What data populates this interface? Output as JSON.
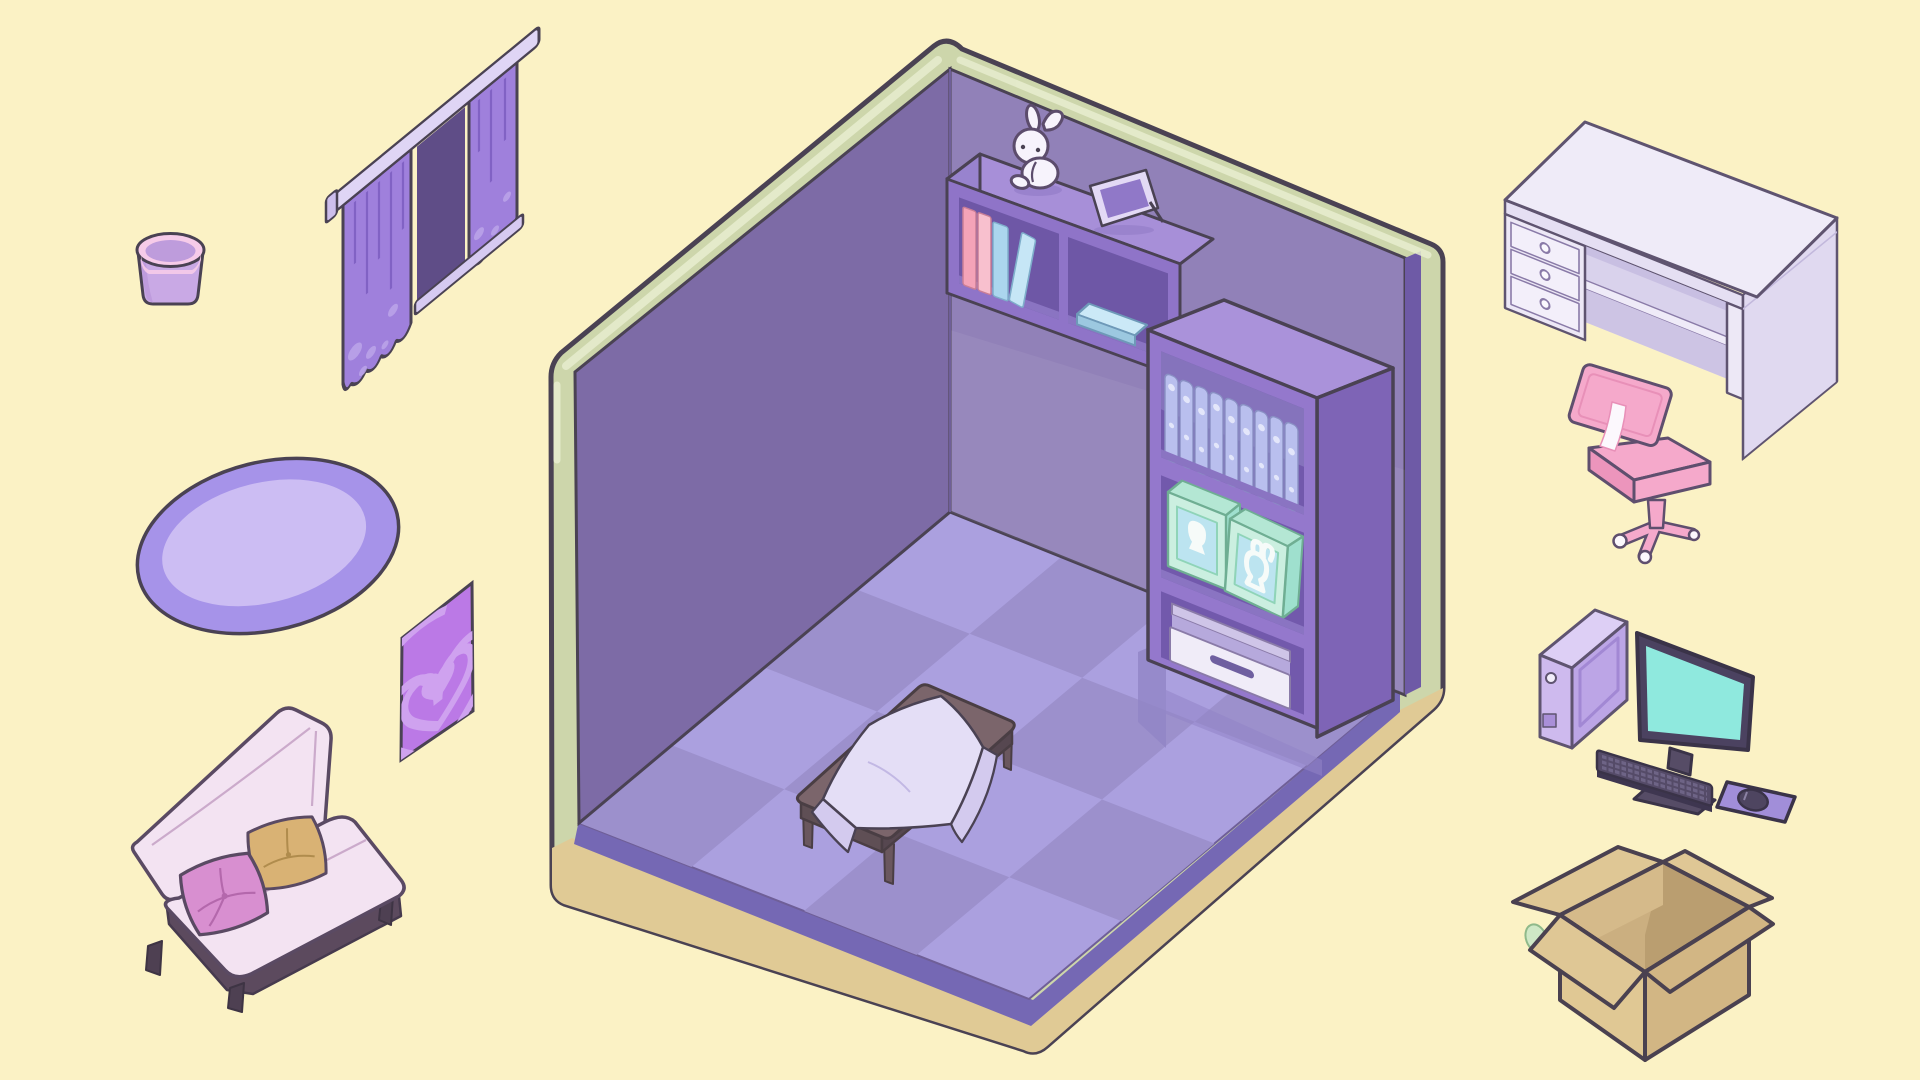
{
  "scene": {
    "title": "Isometric room decoration scene",
    "items": [
      {
        "id": "trash-bin",
        "label": "Trash bin"
      },
      {
        "id": "curtains",
        "label": "Purple curtains with rod"
      },
      {
        "id": "rug",
        "label": "Oval rug"
      },
      {
        "id": "poster",
        "label": "Heart poster"
      },
      {
        "id": "sofa",
        "label": "Pink sofa with two cushions"
      },
      {
        "id": "room",
        "label": "Purple isometric room"
      },
      {
        "id": "wall-shelf",
        "label": "Wall shelf with books"
      },
      {
        "id": "bunny-plush",
        "label": "Bunny plush"
      },
      {
        "id": "picture-frame",
        "label": "Picture frame"
      },
      {
        "id": "bookshelf",
        "label": "Bookshelf with binders, toy boxes and bin"
      },
      {
        "id": "low-table",
        "label": "Low table with cloth"
      },
      {
        "id": "desk",
        "label": "White desk with drawers"
      },
      {
        "id": "desk-chair",
        "label": "Pink desk chair"
      },
      {
        "id": "computer-tower",
        "label": "Computer tower"
      },
      {
        "id": "monitor",
        "label": "Monitor"
      },
      {
        "id": "keyboard",
        "label": "Keyboard"
      },
      {
        "id": "mouse-pad",
        "label": "Mouse pad with mouse"
      },
      {
        "id": "cardboard-box",
        "label": "Open cardboard box"
      }
    ]
  },
  "palette": {
    "background": "#FBF2C5",
    "outline": "#4A4253",
    "shell_green": "#CDD6AB",
    "shell_highlight": "#E7EDCF",
    "wall_left": "#7D6BA6",
    "wall_right": "#9181B8",
    "wall_edge": "#6E5AA6",
    "floor_light": "#ABA0DF",
    "floor_dark": "#9C90CC",
    "floor_rim": "#7568B4",
    "base_tan": "#E0CA95",
    "shelf_front": "#8F74C8",
    "shelf_top": "#A78FD8",
    "shelf_side": "#9883CE",
    "shelf_interior": "#6E57A6",
    "book_pink1": "#F4A3B8",
    "book_pink2": "#F8C0CE",
    "book_blue": "#ABD6EE",
    "flatbook_top": "#CBE9F7",
    "flatbook_side": "#9CC8E0",
    "bunny_white": "#F7F3FC",
    "frame_border": "#E3D9F5",
    "frame_inner": "#9078C8",
    "bookshelf_front": "#9478CC",
    "bookshelf_top": "#AA92DA",
    "bookshelf_side": "#7E64B6",
    "bookshelf_interior": "#7259AC",
    "binder_body": "#B9BFEE",
    "binder_dot": "#E3E6FA",
    "mint_front": "#CBEFE0",
    "mint_side": "#9FE0CE",
    "mint_top": "#B4E7D4",
    "mint_window": "#BCE4F0",
    "mint_silhouette": "#F6FBF9",
    "bin_front": "#F0ECF8",
    "bin_rim": "#CFC5E8",
    "bin_handle": "#6F5FA0",
    "table_top": "#7B656B",
    "table_side": "#5F4F55",
    "table_leg": "#6A575E",
    "cloth": "#E4DEF6",
    "cloth_shade": "#D3CAEE",
    "bucket_rim": "#F6CBE9",
    "bucket_body": "#C9A9E5",
    "bucket_inner": "#BE9CDC",
    "curtain": "#9F80DC",
    "curtain_fold": "#7E5FC2",
    "curtain_window": "#5F4D87",
    "curtain_rod": "#DFD5F5",
    "curtain_sill": "#D6CAF1",
    "curtain_dot": "#BCA5EA",
    "rug_border": "#A693E9",
    "rug_inner": "#CCBDF3",
    "poster_purple": "#BB79E6",
    "poster_design": "#CFA2EF",
    "sofa_body": "#F3E3F2",
    "sofa_seam": "#CBAACB",
    "sofa_base": "#5C4A5E",
    "sofa_leg": "#4E4052",
    "pillow_pink": "#D88FD0",
    "pillow_tan": "#D9B274",
    "desk_top": "#EFEBF8",
    "desk_front": "#EDE8F6",
    "desk_side": "#E0D9F0",
    "desk_opening": "#D9D2EC",
    "desk_band": "#E5DFF3",
    "chair_pink": "#F5A9CB",
    "chair_dark": "#EC95BC",
    "chair_white": "#FCF8FD",
    "tower_front": "#CEBAEE",
    "tower_side": "#BCA5E6",
    "tower_top": "#DDCFF5",
    "monitor_frame": "#4B4260",
    "monitor_screen": "#8FE9DE",
    "monitor_stand": "#564C66",
    "keyboard_body": "#554B68",
    "keyboard_keys": "#6E6486",
    "mousepad": "#A18ED9",
    "mouse": "#4E4560",
    "box_flap": "#DFC795",
    "box_front_left": "#E0C894",
    "box_front_right": "#D2B684",
    "box_interior_dark": "#BA9E70",
    "box_interior_mid": "#CBAF80",
    "box_inner_left": "#D5BA8A"
  }
}
